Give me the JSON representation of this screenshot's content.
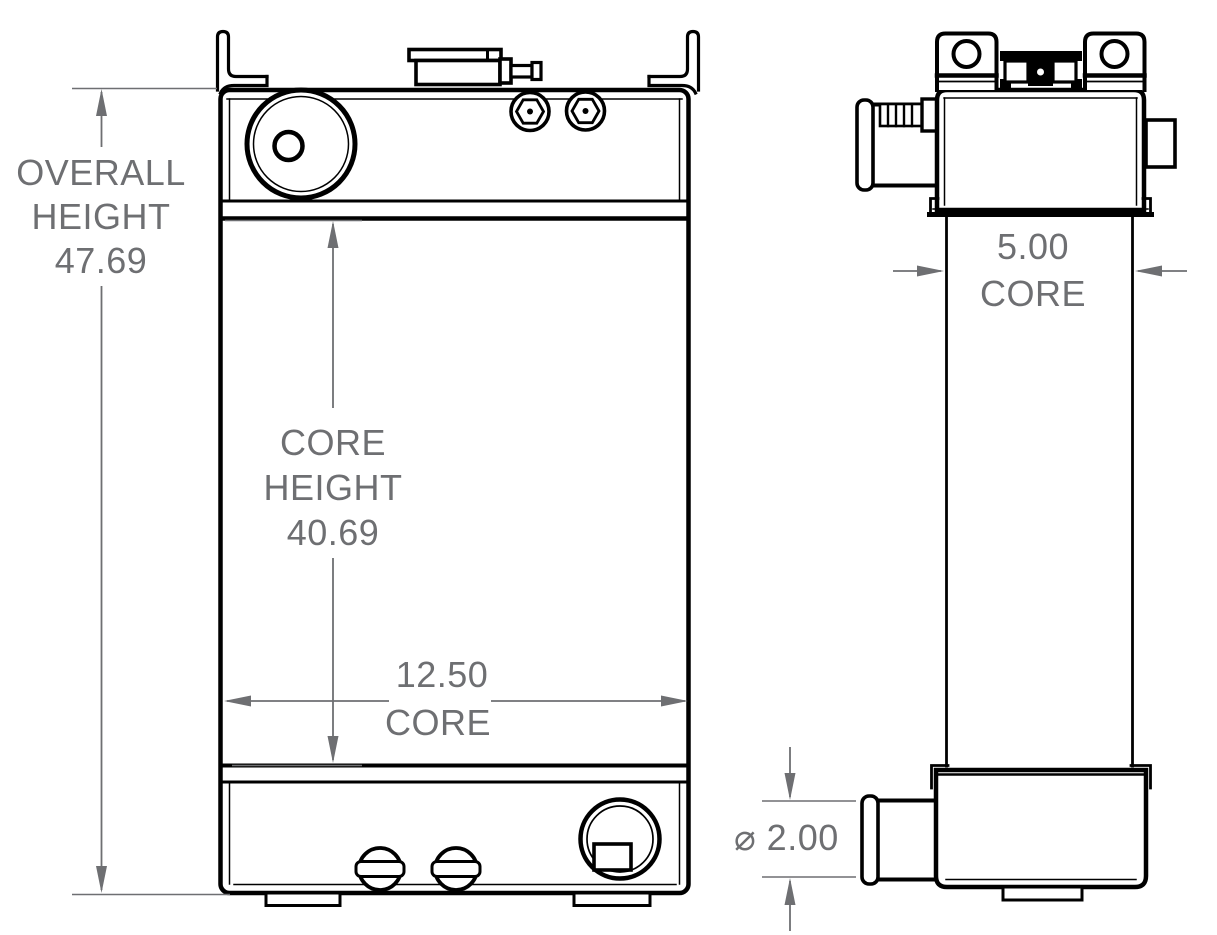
{
  "drawing": {
    "colors": {
      "line": "#000000",
      "dimension": "#6e6f72",
      "background": "#ffffff"
    },
    "dimensions": {
      "overall_height": {
        "label_line1": "OVERALL",
        "label_line2": "HEIGHT",
        "value": "47.69"
      },
      "core_height": {
        "label_line1": "CORE",
        "label_line2": "HEIGHT",
        "value": "40.69"
      },
      "core_width": {
        "value": "12.50",
        "label": "CORE"
      },
      "core_depth": {
        "value": "5.00",
        "label": "CORE"
      },
      "outlet_diameter": {
        "value": "⌀ 2.00"
      }
    }
  }
}
